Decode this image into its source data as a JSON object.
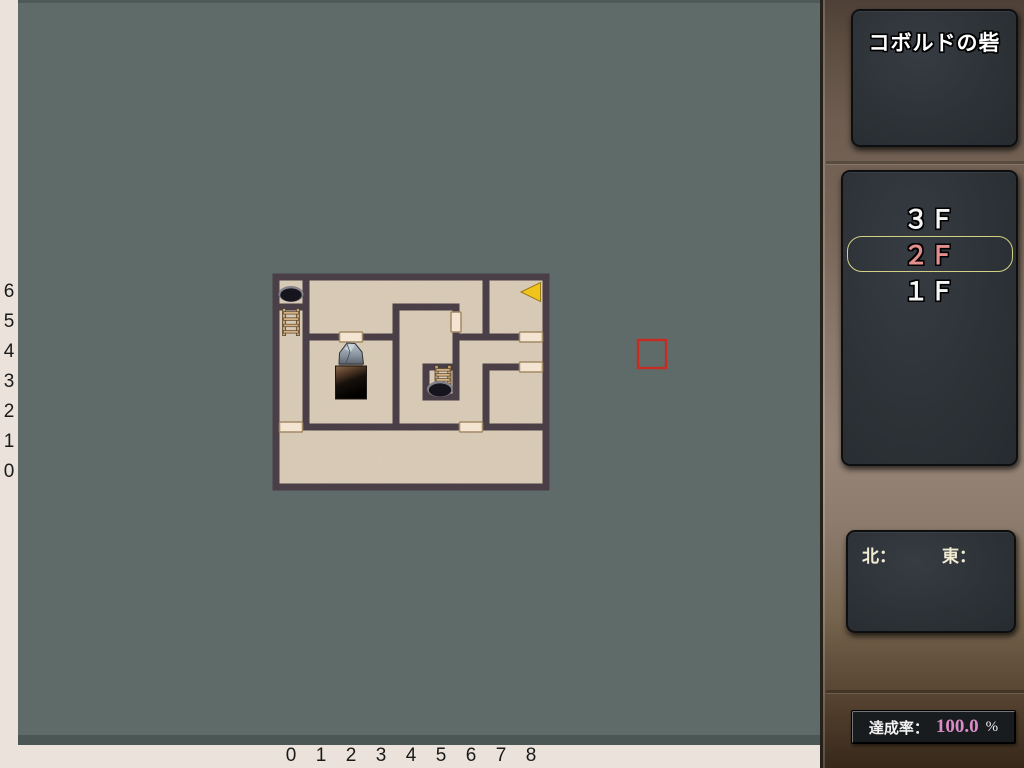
{
  "title_panel": {
    "title": "コボルドの砦"
  },
  "floor_panel": {
    "floors": [
      {
        "label": "３Ｆ",
        "selected": false
      },
      {
        "label": "２Ｆ",
        "selected": true
      },
      {
        "label": "１Ｆ",
        "selected": false
      }
    ],
    "selected_text_color": "#e58e8e",
    "selected_border_color": "#d2d285"
  },
  "compass_panel": {
    "north_label": "北：",
    "east_label": "東："
  },
  "rate_panel": {
    "label": "達成率：",
    "value": "100.0",
    "unit": "%"
  },
  "axes": {
    "rows_top_to_bottom": [
      "6",
      "5",
      "4",
      "3",
      "2",
      "1",
      "0"
    ],
    "cols_left_to_right": [
      "0",
      "1",
      "2",
      "3",
      "4",
      "5",
      "6",
      "7",
      "8"
    ]
  },
  "map": {
    "grid": {
      "cols": 9,
      "rows": 7,
      "cell": 30,
      "origin_x": 276,
      "origin_y": 277,
      "wall_thickness": 7
    },
    "colors": {
      "background": "#5e6b69",
      "floor": "#dacdb9",
      "wall": "#4b3f47",
      "door_fill": "#f3e5d1",
      "door_border": "#a38a66",
      "cursor": "#c62c22",
      "arrow": "#f1c41d",
      "strip": "#ebe3db"
    },
    "v_walls": [
      [
        0,
        0,
        7
      ],
      [
        9,
        0,
        7
      ],
      [
        1,
        0,
        5
      ],
      [
        4,
        1,
        5
      ],
      [
        5,
        3,
        4
      ],
      [
        6,
        1,
        4
      ],
      [
        7,
        0,
        2
      ],
      [
        7,
        3,
        5
      ]
    ],
    "h_walls": [
      [
        0,
        0,
        9
      ],
      [
        7,
        0,
        9
      ],
      [
        1,
        0,
        1
      ],
      [
        1,
        4,
        6
      ],
      [
        2,
        1,
        4
      ],
      [
        2,
        6,
        9
      ],
      [
        3,
        5,
        6
      ],
      [
        3,
        7,
        9
      ],
      [
        4,
        5,
        6
      ],
      [
        5,
        0,
        9
      ]
    ],
    "doors_h": [
      [
        2,
        2
      ],
      [
        8,
        2
      ],
      [
        8,
        3
      ],
      [
        0,
        5
      ],
      [
        6,
        5
      ]
    ],
    "doors_v": [
      [
        6,
        1
      ]
    ],
    "items": [
      {
        "type": "pit",
        "name": "pit-icon",
        "col": 0,
        "row": 0
      },
      {
        "type": "ladder",
        "name": "ladder-up-icon",
        "col": 0,
        "row": 1
      },
      {
        "type": "rock",
        "name": "boulder-icon",
        "col": 2,
        "row": 2
      },
      {
        "type": "stairs-dark",
        "name": "stairs-down-icon",
        "col": 2,
        "row": 3
      },
      {
        "type": "pit-ladder",
        "name": "pit-with-ladder-icon",
        "col": 5,
        "row": 3
      },
      {
        "type": "player-arrow",
        "name": "player-arrow-icon",
        "col": 8,
        "row": 0,
        "facing": "west"
      }
    ],
    "cursor_px": {
      "x": 637,
      "y": 339,
      "w": 30,
      "h": 30
    }
  }
}
